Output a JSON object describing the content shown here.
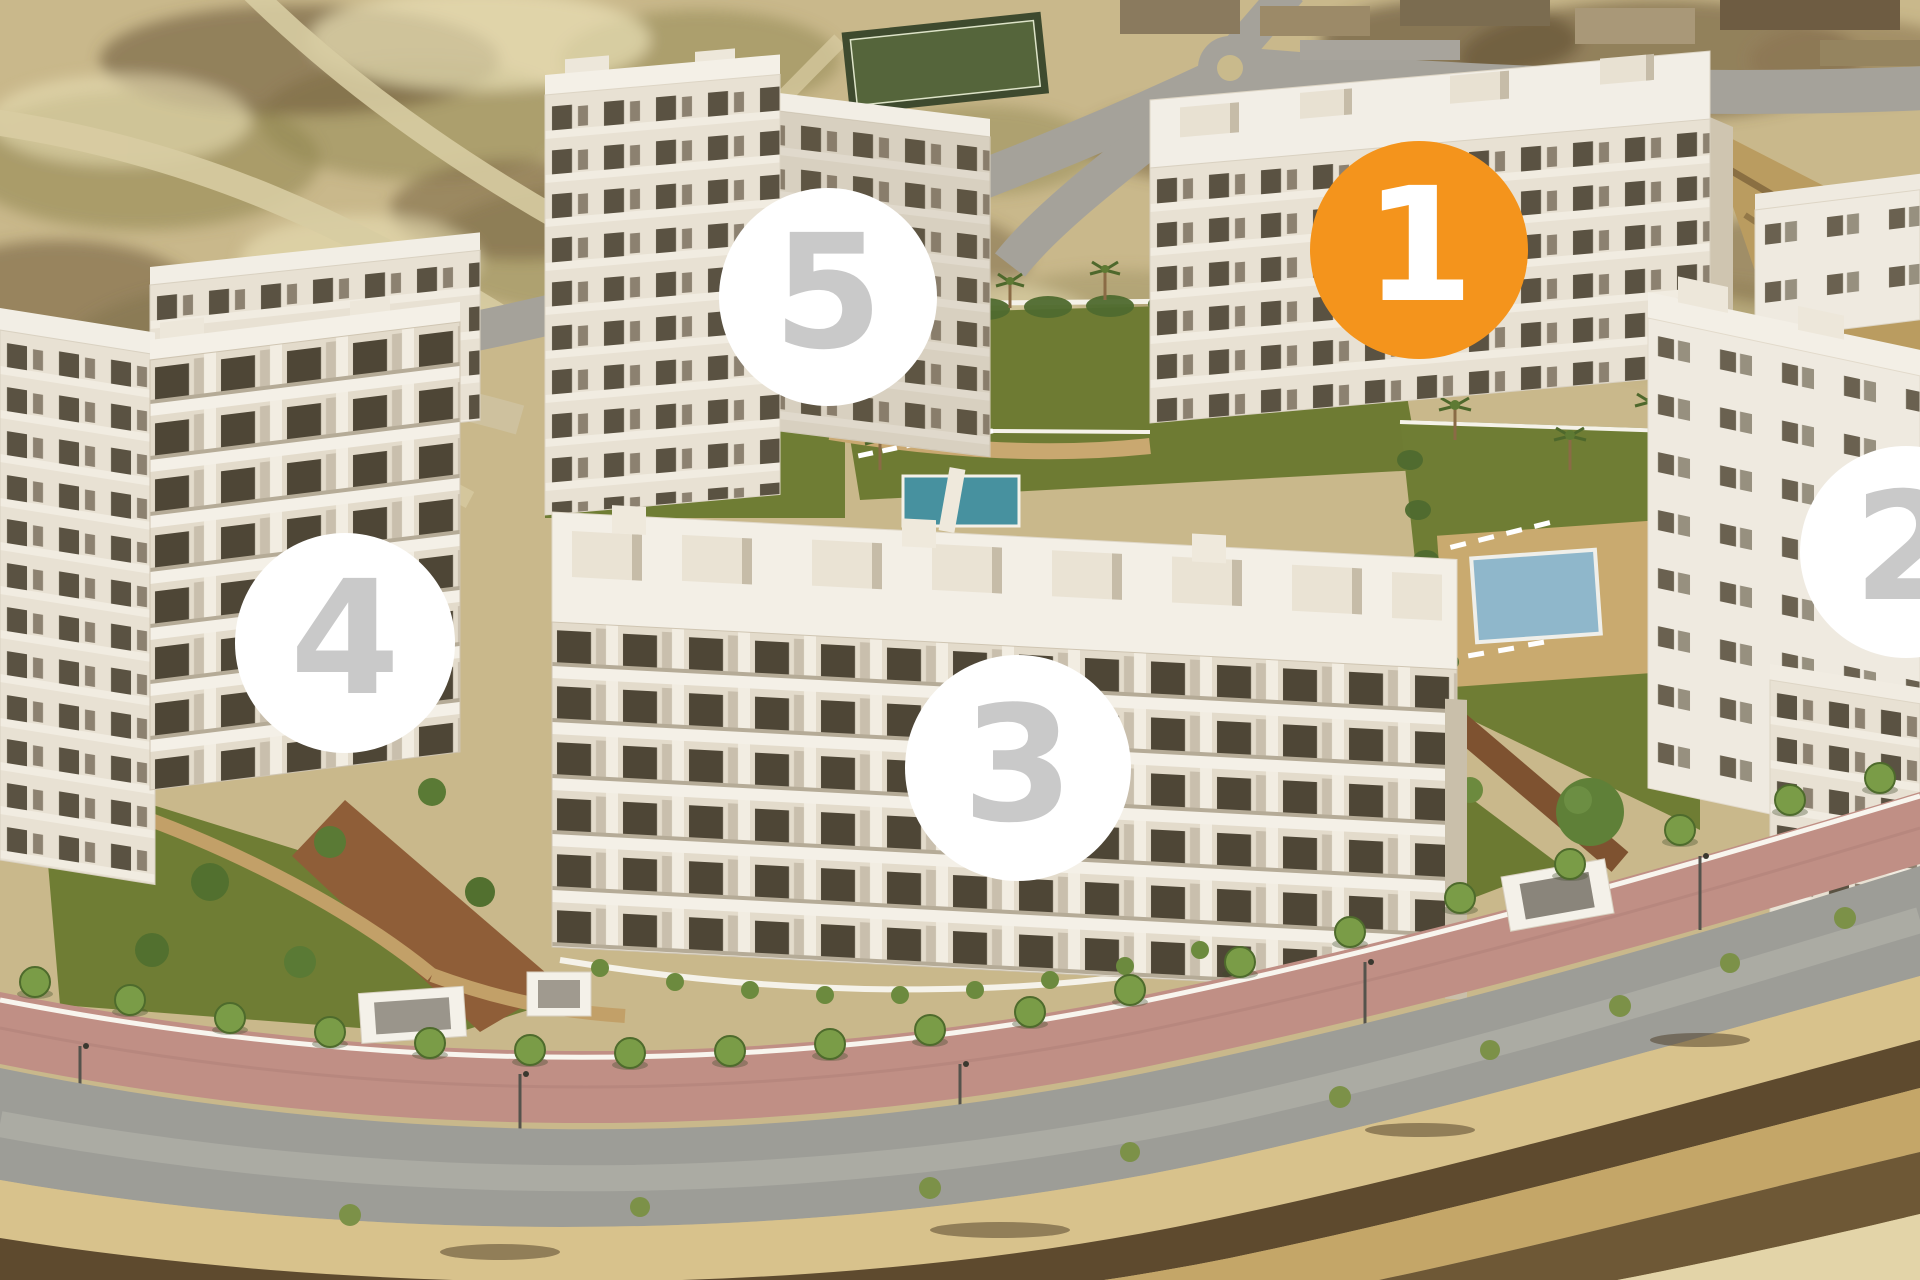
{
  "image": {
    "type": "aerial-3d-render",
    "subject": "new-build residential apartment complex with five numbered building markers, gardens, pools, perimeter road and desert scrubland"
  },
  "colors": {
    "marker_highlight_fill": "#F4941C",
    "marker_highlight_text": "#FFFFFF",
    "marker_default_fill": "#FFFFFF",
    "marker_default_text": "#C9C9C9"
  },
  "markers": [
    {
      "label": "1",
      "variant": "highlighted"
    },
    {
      "label": "2",
      "variant": "default"
    },
    {
      "label": "3",
      "variant": "default"
    },
    {
      "label": "4",
      "variant": "default"
    },
    {
      "label": "5",
      "variant": "default"
    }
  ]
}
